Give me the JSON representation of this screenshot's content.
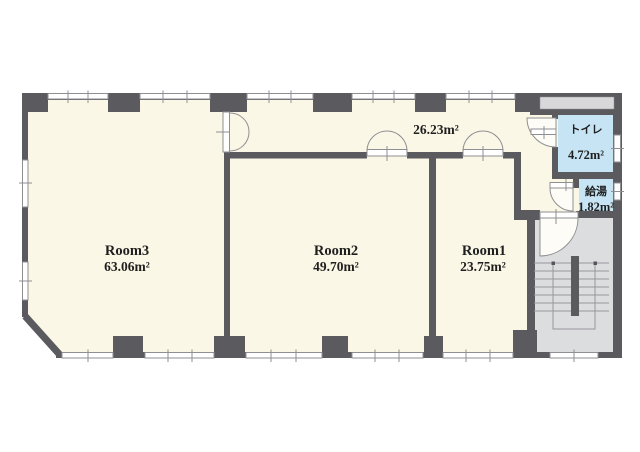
{
  "plan_title": "office floor plan",
  "rooms": {
    "room3": {
      "name": "Room3",
      "area": "63.06m²"
    },
    "room2": {
      "name": "Room2",
      "area": "49.70m²"
    },
    "room1": {
      "name": "Room1",
      "area": "23.75m²"
    },
    "corridor": {
      "area": "26.23m²"
    },
    "toilet": {
      "name": "トイレ",
      "area": "4.72m²"
    },
    "water_heater": {
      "name": "給湯",
      "area": "1.82m²"
    }
  },
  "colors": {
    "wall": "#5a5a5f",
    "floor": "#faf7e6",
    "wet_area": "#c6e4f4",
    "stair": "#dcdddf",
    "shaft": "#d8d8db",
    "outline": "#8f8f93",
    "step_line": "#98989c",
    "text": "#1f1f1f"
  }
}
